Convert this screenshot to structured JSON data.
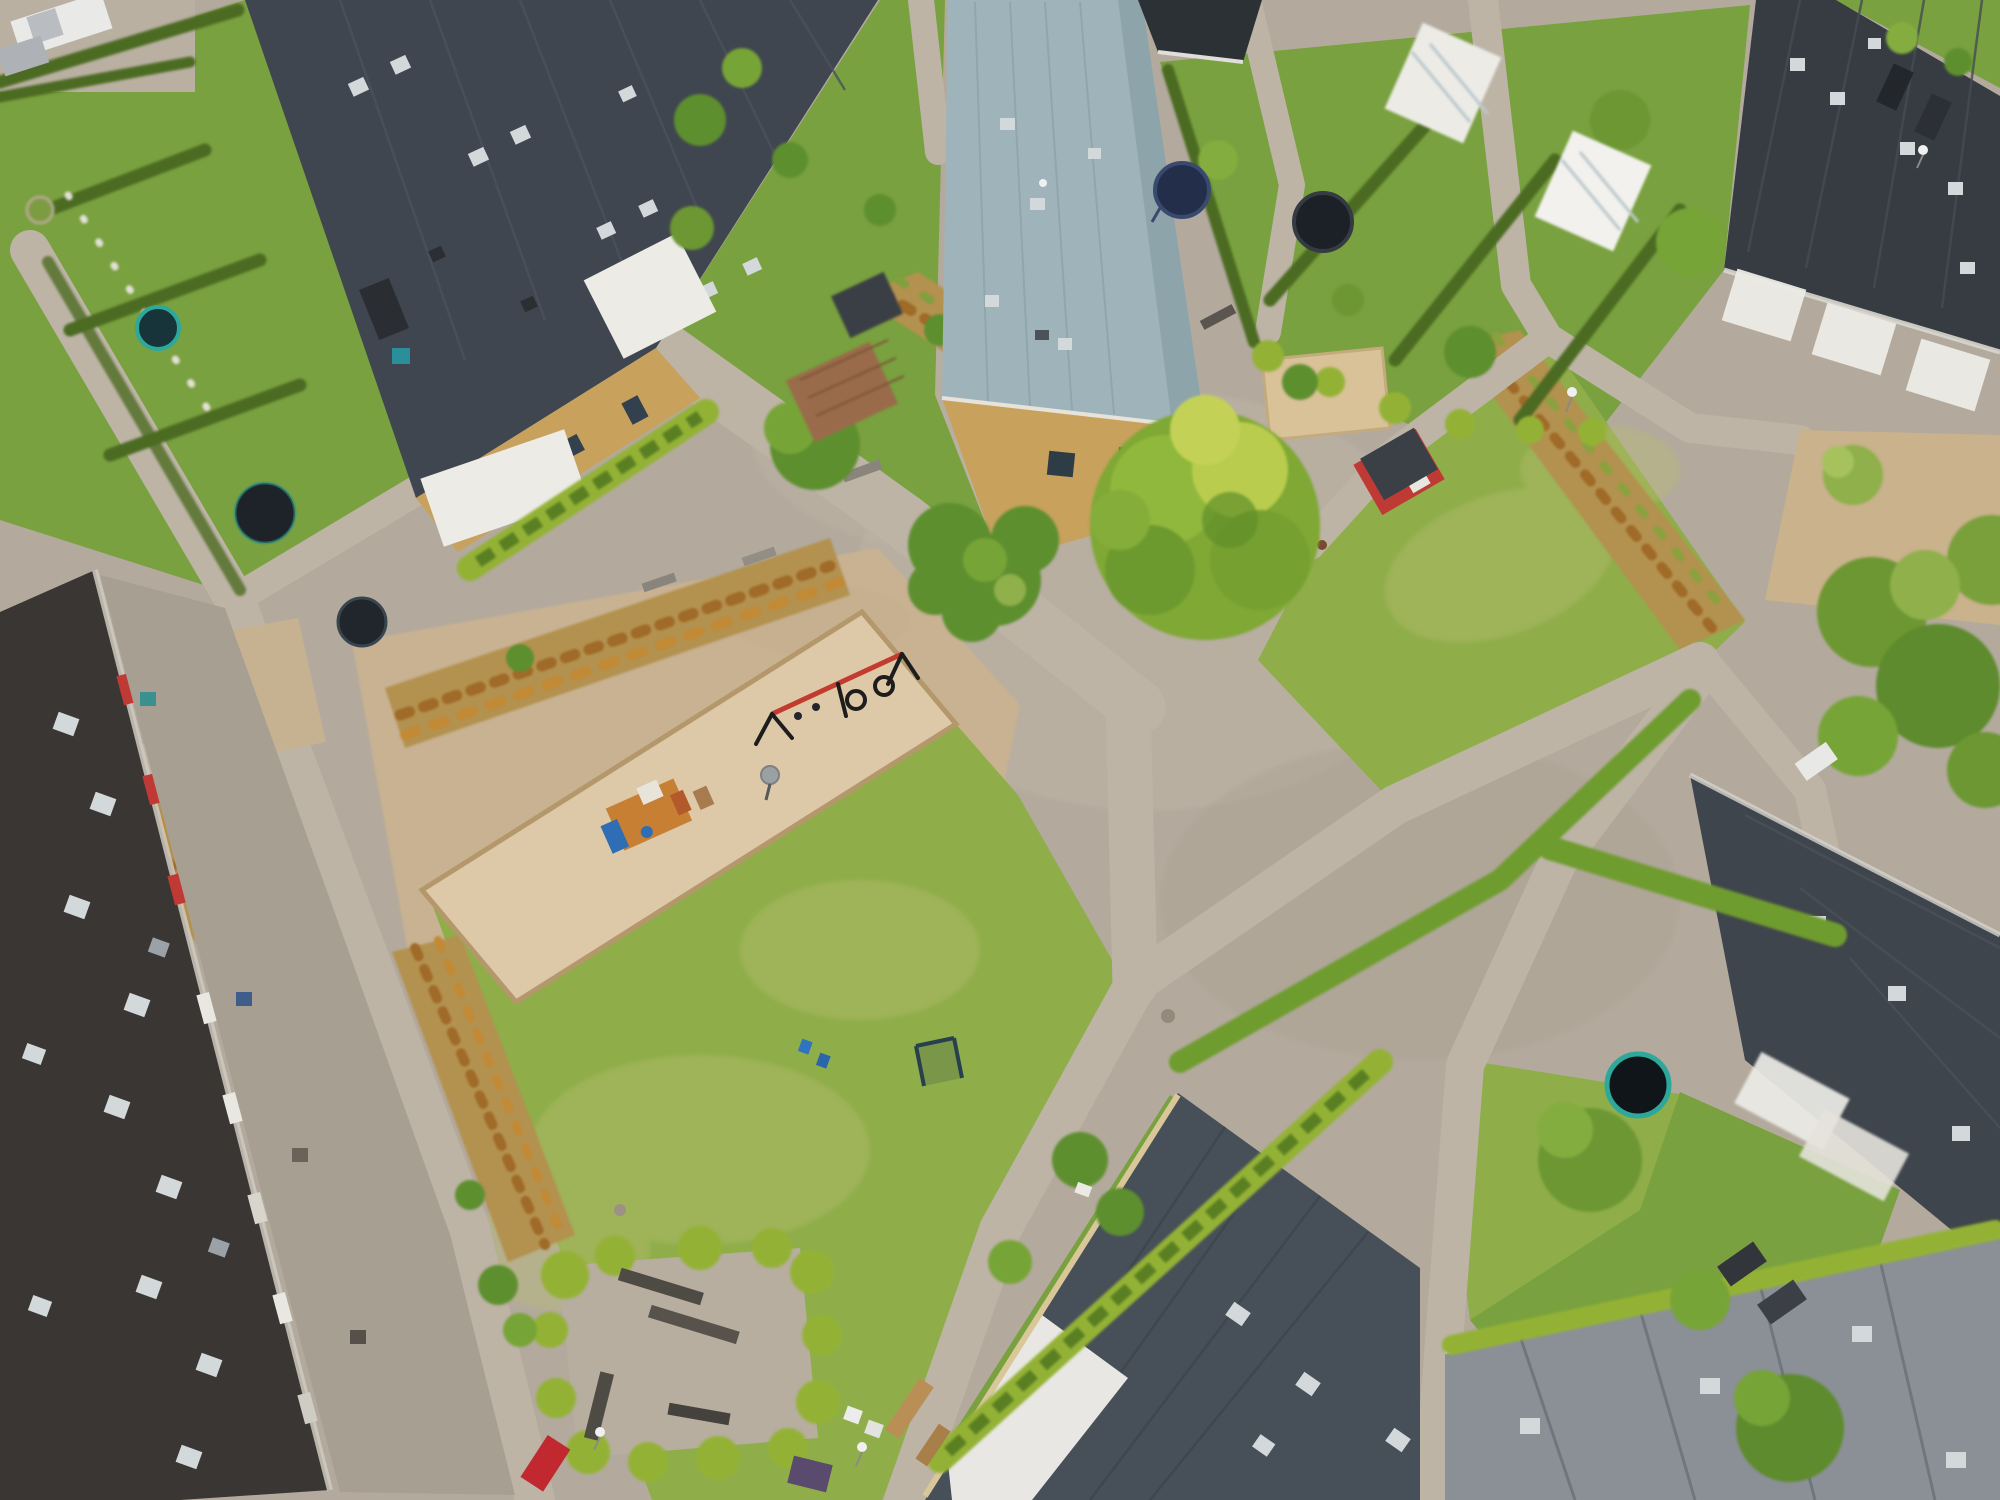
{
  "scene": {
    "type": "aerial-drone-photograph",
    "description": "Top-down aerial view of a suburban residential neighborhood: long row houses with dark roofs and private hedged gardens surround a communal area with green lawns, sandy playground, walking paths, planted strips of rust-colored shrubs, a large tree on a paved plaza, a red playhouse and a sand square.",
    "no_visible_text": true
  },
  "palette": {
    "path": "#b3aa9d",
    "path_light": "#bdb4a6",
    "sand_rough": "#c8b292",
    "sand_clean": "#ddc9a7",
    "sand_border": "#b4986c",
    "plaza_beige": "#c9b28c",
    "lawn": "#8fae4a",
    "lawn_dry": "#b9bd6f",
    "garden": "#79a13f",
    "hedge_dark": "#4c6b22",
    "hedge_bright": "#93b235",
    "bush": "#5e8f2f",
    "tree_main": "#7fa834",
    "tree_light": "#b9cc4d",
    "rust_base": "#b3914f",
    "rust_dark": "#a06a28",
    "rust_warm": "#c28a35",
    "roof_dark": "#3f4650",
    "roof_panel": "#4a525d",
    "roof_tr": "#363c42",
    "roof_apartment": "#3a3633",
    "roof_pale": "#9fb4ba",
    "roof_pale_edge": "#8da4ab",
    "roof_bottom": "#474f58",
    "roof_slate": "#8b9096",
    "roof_small": "#2c3136",
    "wall_yellow": "#c8a15c",
    "white": "#ecebe6",
    "red_accent": "#c03a35",
    "swing_red": "#c23b2e",
    "play_orange": "#c77f33",
    "play_blue": "#2f6db5",
    "trampoline_teal": "#2ea89a",
    "trampoline_dark": "#1d2329",
    "car_red": "#c22830"
  },
  "objects": [
    {
      "name": "row-house-top-left",
      "feature": "long dark roof, yellow brick facade, white canopies",
      "location": "top-left"
    },
    {
      "name": "pale-roof-building",
      "feature": "light blue-gray metal roof, yellow gable wall",
      "location": "top-center"
    },
    {
      "name": "row-house-top-right",
      "feature": "dark roof with white verandas and conservatories",
      "location": "top-right"
    },
    {
      "name": "apartment-block",
      "feature": "very dark roof, red and white awnings, terraces",
      "location": "bottom-left"
    },
    {
      "name": "building-bottom-center",
      "feature": "blue-gray panel roof with white section",
      "location": "bottom-center"
    },
    {
      "name": "building-bottom-right",
      "feature": "dark gray roof",
      "location": "right-bottom"
    },
    {
      "name": "slate-roof-building",
      "feature": "light gray ribbed roof",
      "location": "bottom-right corner"
    },
    {
      "name": "playground",
      "feature": "sand area with wooden border, swing set with red top bar and tire swings, climbing frame with slide",
      "location": "center-left"
    },
    {
      "name": "big-tree",
      "feature": "large yellow-green crown on paved plaza",
      "location": "center"
    },
    {
      "name": "sand-square",
      "feature": "square sandbox on plaza",
      "location": "center-right"
    },
    {
      "name": "red-playhouse",
      "feature": "small red hut with dark roof",
      "location": "center-right"
    },
    {
      "name": "balance-beam-with-children",
      "location": "center plaza"
    },
    {
      "name": "football-goal",
      "location": "left lawn"
    },
    {
      "name": "bench-plaza",
      "feature": "paved corner with benches ringed by hedge",
      "location": "bottom-center-left"
    },
    {
      "name": "trampolines",
      "count": 6,
      "locations": [
        "top-left gardens x3",
        "right of pale-roof building",
        "top-right gardens",
        "bottom-right garden strip"
      ]
    },
    {
      "name": "planted-strips",
      "feature": "rows of rust-orange shrubs along paths",
      "count": 5
    },
    {
      "name": "vehicles",
      "items": [
        "white pickup top-left parking",
        "silver car top-left",
        "dark car on top-left patio",
        "red car on road bottom-left",
        "white car on right path",
        "two dark cars bottom-right garden"
      ]
    },
    {
      "name": "street-lamps",
      "count": 5
    },
    {
      "name": "walking-paths",
      "feature": "light gray asphalt network crossing the green"
    }
  ]
}
